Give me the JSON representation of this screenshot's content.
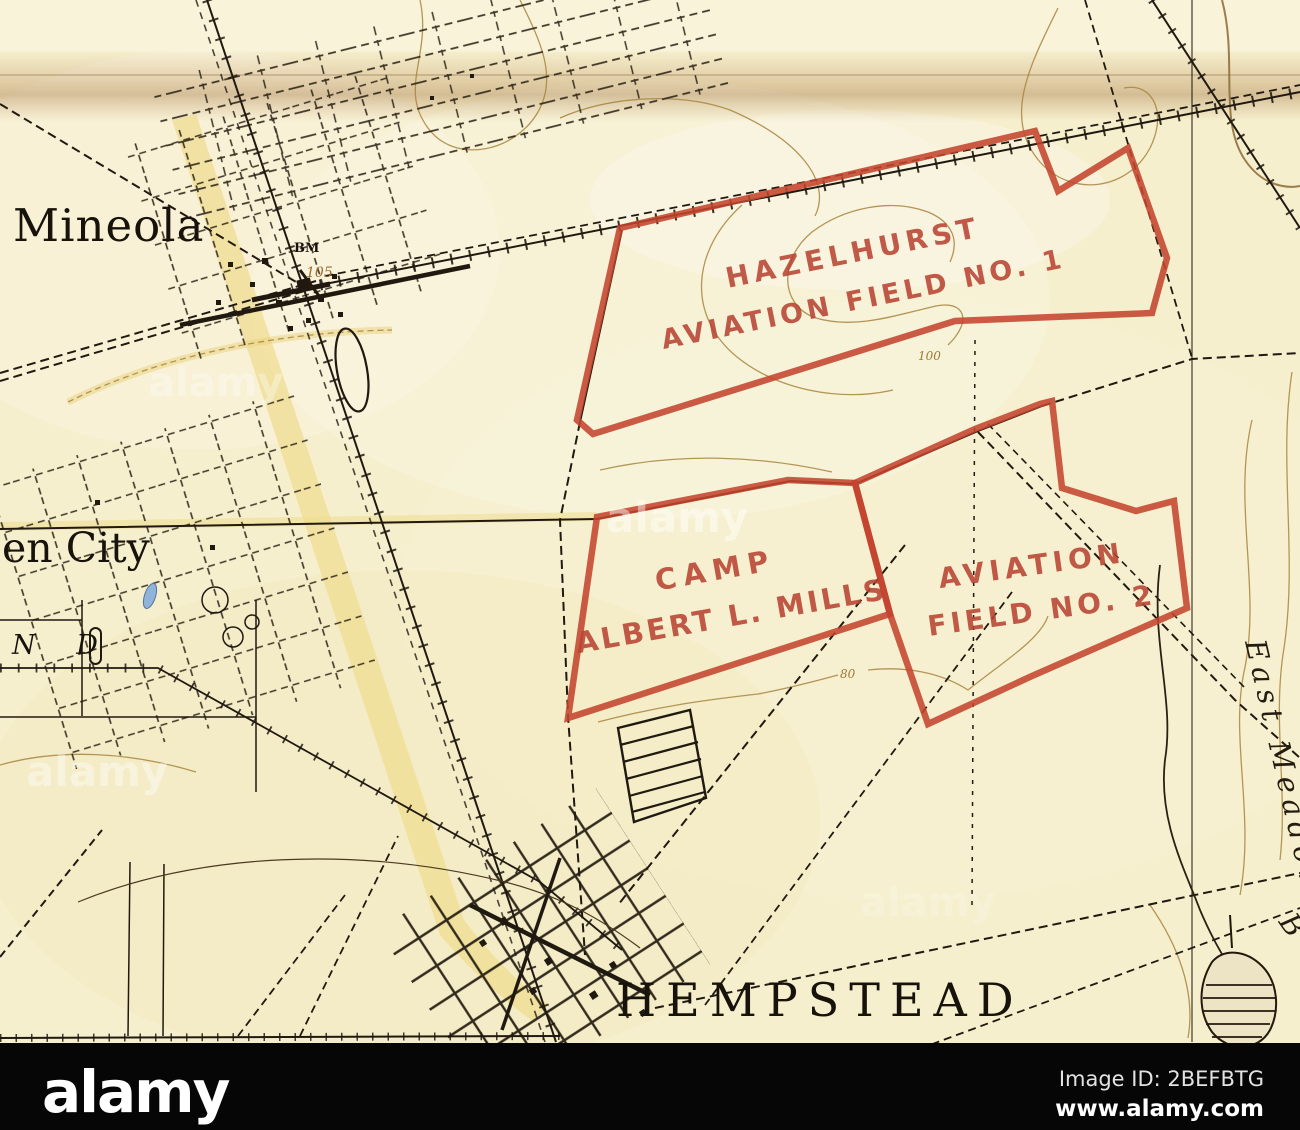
{
  "map": {
    "towns": {
      "mineola": "Mineola",
      "garden_city_partial": "en City",
      "nd_partial": "N D",
      "hempstead": "HEMPSTEAD"
    },
    "hydro": {
      "east_meadow": "East Meadow",
      "brook_initial": "B"
    },
    "benchmark": {
      "bm": "BM",
      "elevation": "105"
    },
    "contour_labels": {
      "c100": "100",
      "c80": "80"
    },
    "overlays": {
      "hazelhurst": {
        "line1": "HAZELHURST",
        "line2": "AVIATION FIELD NO. 1"
      },
      "camp_mills": {
        "line1": "CAMP",
        "line2": "ALBERT L. MILLS"
      },
      "field2": {
        "line1": "AVIATION",
        "line2": "FIELD NO. 2"
      }
    },
    "colors": {
      "paper": "#f6efce",
      "overprint_red": "#c4442e",
      "label_red": "#b84433",
      "ink": "#201910",
      "contour_brown": "#a8853e",
      "pond_blue": "#8fb3d9"
    }
  },
  "watermark": {
    "text": "alamy"
  },
  "footer": {
    "logo": "alamy",
    "image_id": "Image ID: 2BEFBTG",
    "website": "www.alamy.com"
  }
}
